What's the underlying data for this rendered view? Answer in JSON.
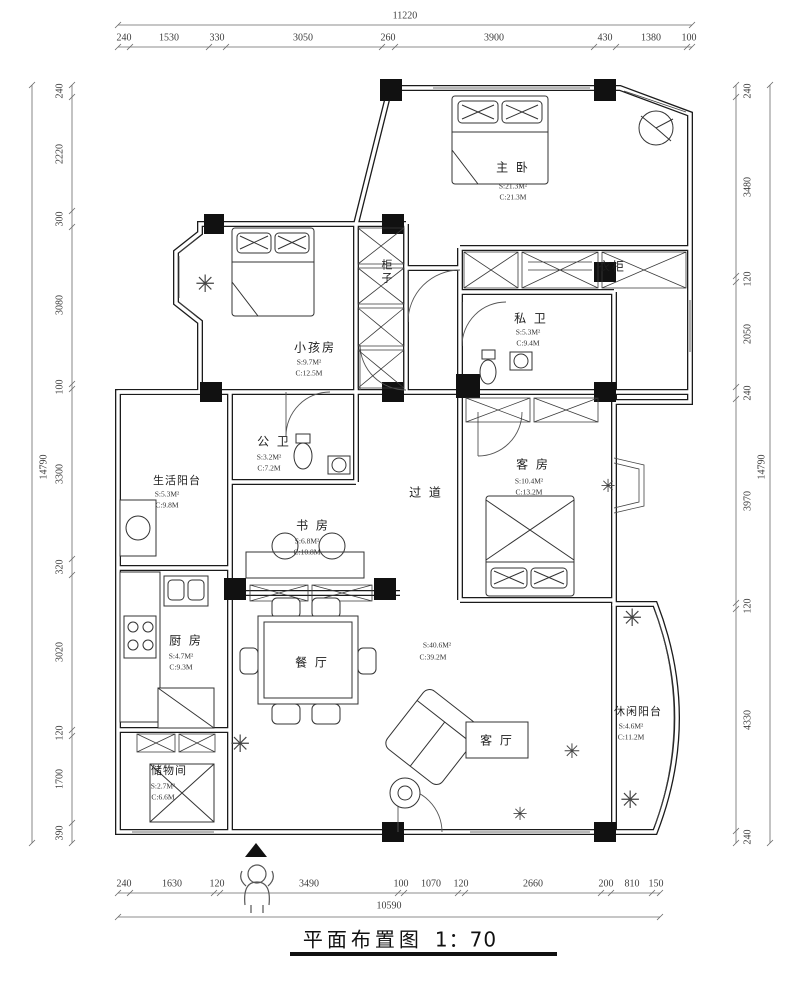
{
  "title": {
    "name": "平面布置图",
    "scale": "1：70"
  },
  "dimensions": {
    "top": {
      "total": "11220",
      "segments": [
        "240",
        "1530",
        "330",
        "3050",
        "260",
        "3900",
        "430",
        "1380",
        "100"
      ]
    },
    "bottom": {
      "total": "10590",
      "segments": [
        "240",
        "1630",
        "120",
        "3490",
        "100",
        "1070",
        "120",
        "2660",
        "200",
        "810",
        "150"
      ]
    },
    "left": {
      "total": "14790",
      "segments": [
        "240",
        "2220",
        "300",
        "3080",
        "100",
        "3300",
        "320",
        "3020",
        "120",
        "1700",
        "390"
      ]
    },
    "right": {
      "total": "14790",
      "segments": [
        "240",
        "3480",
        "120",
        "2050",
        "240",
        "3970",
        "120",
        "4330",
        "240"
      ]
    }
  },
  "rooms": {
    "master_bedroom": {
      "name": "主 卧",
      "area": "S:21.3M²",
      "circumference": "C:21.3M"
    },
    "kids_room": {
      "name": "小孩房",
      "area": "S:9.7M²",
      "circumference": "C:12.5M"
    },
    "cabinet": {
      "name": "柜子"
    },
    "wardrobe": {
      "name": "衣柜"
    },
    "private_bathroom": {
      "name": "私 卫",
      "area": "S:5.3M²",
      "circumference": "C:9.4M"
    },
    "public_bathroom": {
      "name": "公 卫",
      "area": "S:3.2M²",
      "circumference": "C:7.2M"
    },
    "service_balcony": {
      "name": "生活阳台",
      "area": "S:5.3M²",
      "circumference": "C:9.8M"
    },
    "study": {
      "name": "书 房",
      "area": "S:6.8M²",
      "circumference": "C:10.8M"
    },
    "hallway": {
      "name": "过 道"
    },
    "guest_room": {
      "name": "客 房",
      "area": "S:10.4M²",
      "circumference": "C:13.2M"
    },
    "kitchen": {
      "name": "厨 房",
      "area": "S:4.7M²",
      "circumference": "C:9.3M"
    },
    "dining_room": {
      "name": "餐 厅"
    },
    "living_dining_stats": {
      "area": "S:40.6M²",
      "circumference": "C:39.2M"
    },
    "living_room": {
      "name": "客 厅"
    },
    "storage": {
      "name": "储物间",
      "area": "S:2.7M²",
      "circumference": "C:6.6M"
    },
    "leisure_balcony": {
      "name": "休闲阳台",
      "area": "S:4.6M²",
      "circumference": "C:11.2M"
    }
  }
}
